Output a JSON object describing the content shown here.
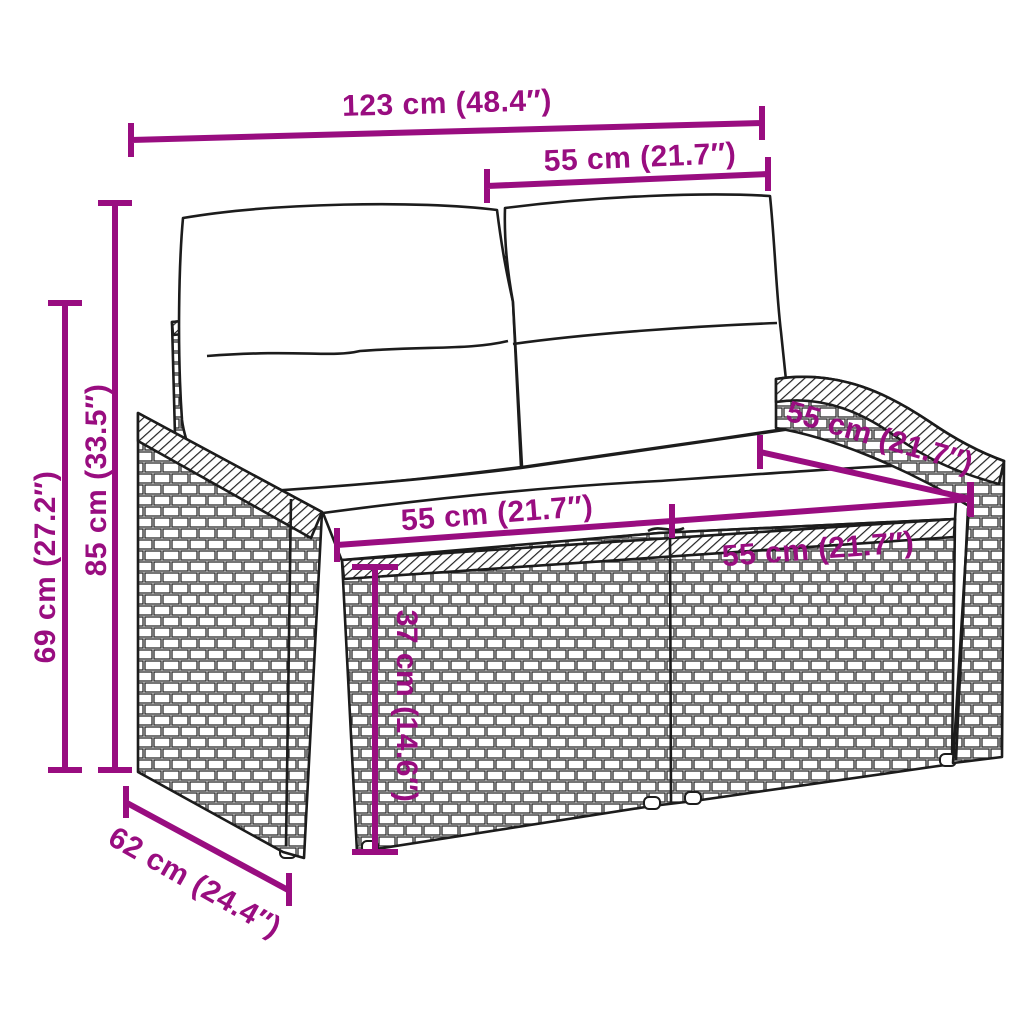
{
  "diagram": {
    "figure": "wicker-loveseat-dimension-drawing",
    "accent_color": "#990D80",
    "outline_color": "#1C1C1C",
    "background_color": "#FFFFFF",
    "dimensions": [
      {
        "id": "overall-width",
        "label": "123 cm (48.4″)"
      },
      {
        "id": "backrest-width",
        "label": "55 cm (21.7″)"
      },
      {
        "id": "overall-height",
        "label": "85 cm (33.5″)"
      },
      {
        "id": "arm-height",
        "label": "69 cm (27.2″)"
      },
      {
        "id": "seat-depth",
        "label": "55 cm (21.7″)"
      },
      {
        "id": "seat-width-left",
        "label": "55 cm (21.7″)"
      },
      {
        "id": "seat-width-right",
        "label": "55 cm (21.7″)"
      },
      {
        "id": "seat-height",
        "label": "37 cm (14.6″)"
      },
      {
        "id": "base-depth",
        "label": "62 cm (24.4″)"
      }
    ]
  }
}
